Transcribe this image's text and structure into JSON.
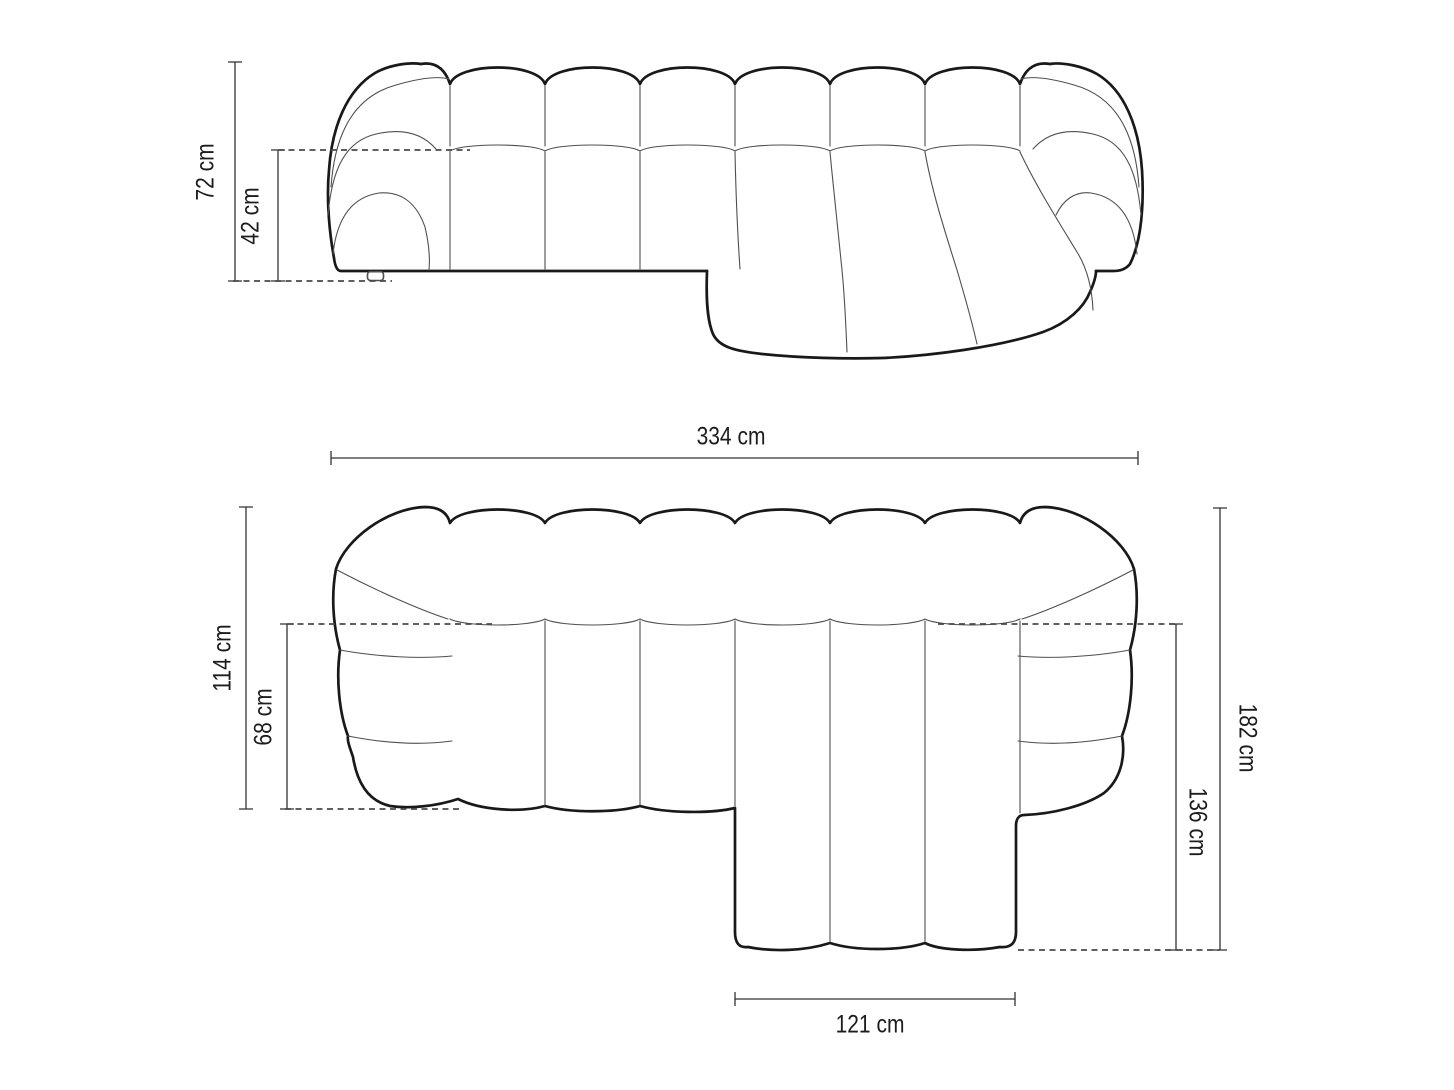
{
  "front_view": {
    "height_label": "72 cm",
    "seat_height_label": "42 cm",
    "width_label": "334 cm"
  },
  "top_view": {
    "depth_label": "114 cm",
    "seat_depth_label": "68 cm",
    "total_depth_with_chaise_label": "182 cm",
    "chaise_depth_label": "136 cm",
    "chaise_width_label": "121 cm"
  },
  "colors": {
    "background": "#ffffff",
    "outline": "#191919",
    "seam_line": "#4f4f4f",
    "dimension_line": "#333333"
  }
}
